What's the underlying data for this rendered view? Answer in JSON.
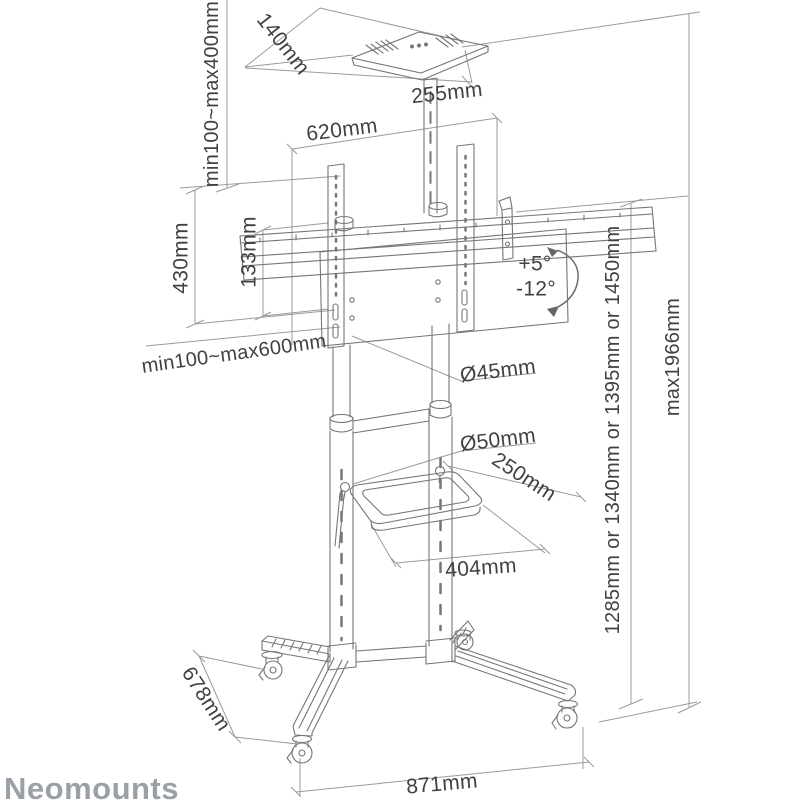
{
  "brand": {
    "logo_text": "Neomounts"
  },
  "annotations": {
    "tray_depth": "140mm",
    "tray_column_range": "min100~max400mm",
    "tray_width": "255mm",
    "bracket_width": "620mm",
    "vesa_height": "430mm",
    "rail_offset": "133mm",
    "tilt_up": "+5°",
    "tilt_down": "-12°",
    "vesa_width_range": "min100~max600mm",
    "upper_pole_diameter": "Ø45mm",
    "lower_pole_diameter": "Ø50mm",
    "shelf_depth": "250mm",
    "shelf_width": "404mm",
    "screen_height_options": "1285mm or 1340mm or 1395mm or 1450mm",
    "max_height": "max1966mm",
    "base_depth": "678mm",
    "base_width": "871mm"
  },
  "colors": {
    "drawing_line": "#767676",
    "dimension_line": "#9b9b9b",
    "label_text": "#414141",
    "logo_text": "#9ba0a6",
    "background": "#ffffff"
  }
}
